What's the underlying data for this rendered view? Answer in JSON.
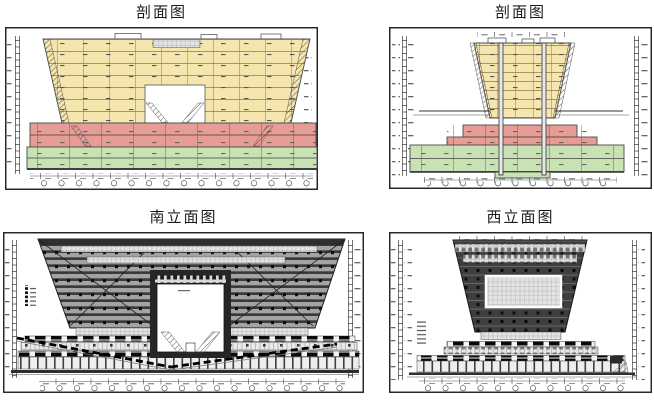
{
  "sheet": {
    "background": "#ffffff"
  },
  "panels": [
    {
      "id": "section-long",
      "title": "剖面图"
    },
    {
      "id": "section-cross",
      "title": "剖面图"
    },
    {
      "id": "elevation-south",
      "title": "南立面图"
    },
    {
      "id": "elevation-west",
      "title": "西立面图"
    }
  ],
  "colors": {
    "paper": "#ffffff",
    "frame": "#1c1c1c",
    "ink": "#3f3f3f",
    "floor_yellow": "#f5e6b0",
    "podium_red": "#e79d95",
    "basement_green": "#c9e2b3",
    "facade_dark": "#3e3e3e",
    "facade_mid": "#a3a3a3",
    "facade_light": "#e4e4e4",
    "band_black": "#0a0a0a"
  }
}
